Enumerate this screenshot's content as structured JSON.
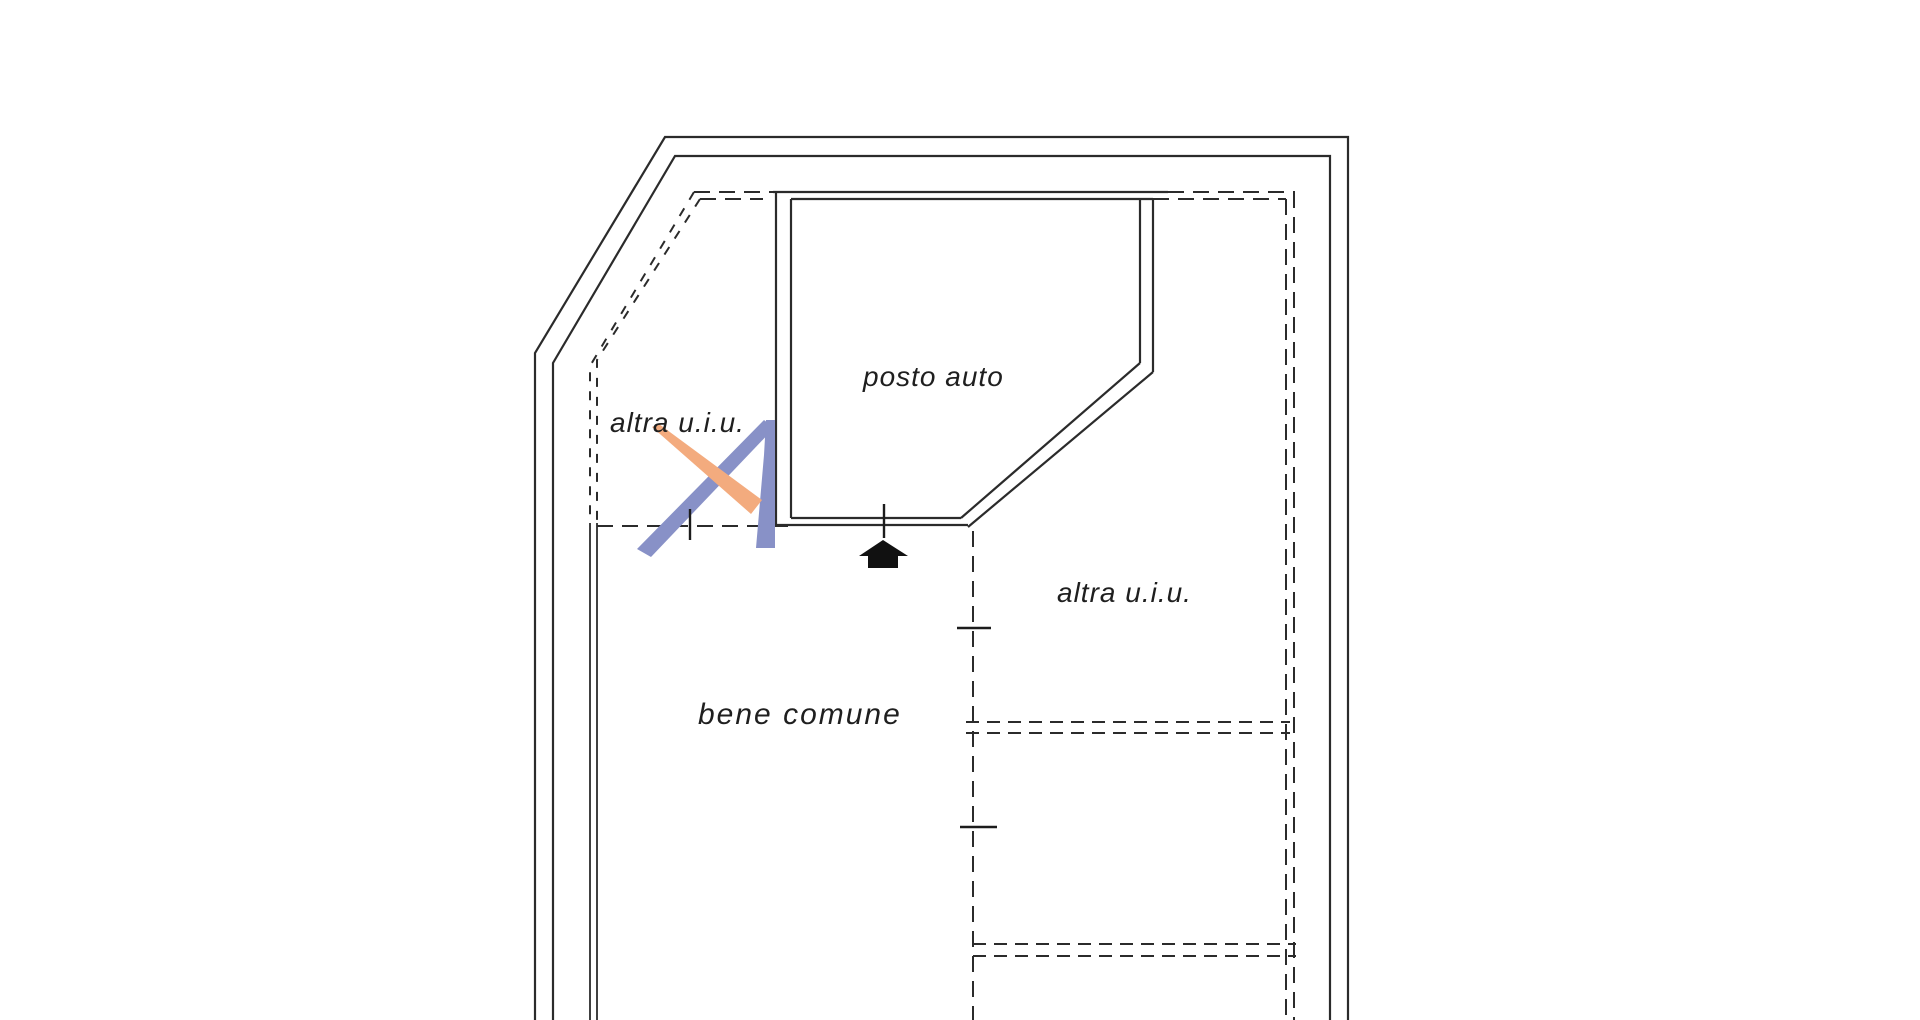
{
  "page": {
    "background": "#ffffff",
    "width": 1920,
    "height": 1020,
    "description": "Cadastral floor plan drawing (planimetria) on white background"
  },
  "plan": {
    "labels": {
      "posto_auto": "posto auto",
      "altra_uiu_left": "altra u.i.u.",
      "altra_uiu_right": "altra u.i.u.",
      "bene_comune": "bene comune"
    },
    "colors": {
      "line": "#2b2b2b",
      "text": "#1f1f1f",
      "logo_blue": "#8891c7",
      "logo_orange": "#f3ab7e",
      "arrow_black": "#111111"
    },
    "icons": {
      "entrance_arrow": "solid black up-arrow marking the entrance of posto auto",
      "watermark_logo": "blue and orange stylized letter-A watermark"
    }
  }
}
